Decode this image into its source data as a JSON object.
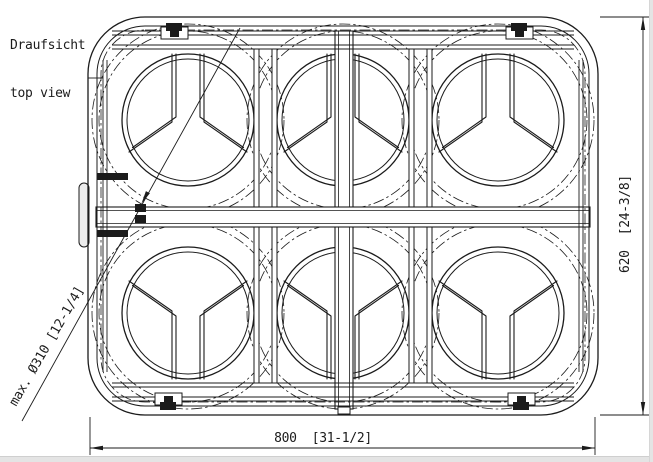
{
  "title": {
    "line1": "Draufsicht",
    "line2": "top view"
  },
  "dimensions": {
    "width_label": "800  [31-1/2]",
    "height_label": "620  [24-3/8]",
    "max_diameter_label": "max. Ø310 [12-1/4]"
  },
  "drawing": {
    "type": "technical-top-view",
    "description": "top view of a 2x3 bottle/cylinder rack frame",
    "grid": {
      "rows": 2,
      "cols": 3,
      "positions": 6
    },
    "columns_x": [
      188,
      343,
      498
    ],
    "rows_y": [
      120,
      313
    ],
    "ring_outer_r": 66,
    "ring_inner_r": 61,
    "clearance_radii": [
      89,
      96
    ],
    "frame": {
      "x": 88,
      "y": 17,
      "w": 510,
      "h": 398,
      "corner_r": 57
    },
    "colors": {
      "line": "#1b1b1b",
      "background": "#ffffff",
      "panel_edge": "#e4e4e4"
    }
  }
}
